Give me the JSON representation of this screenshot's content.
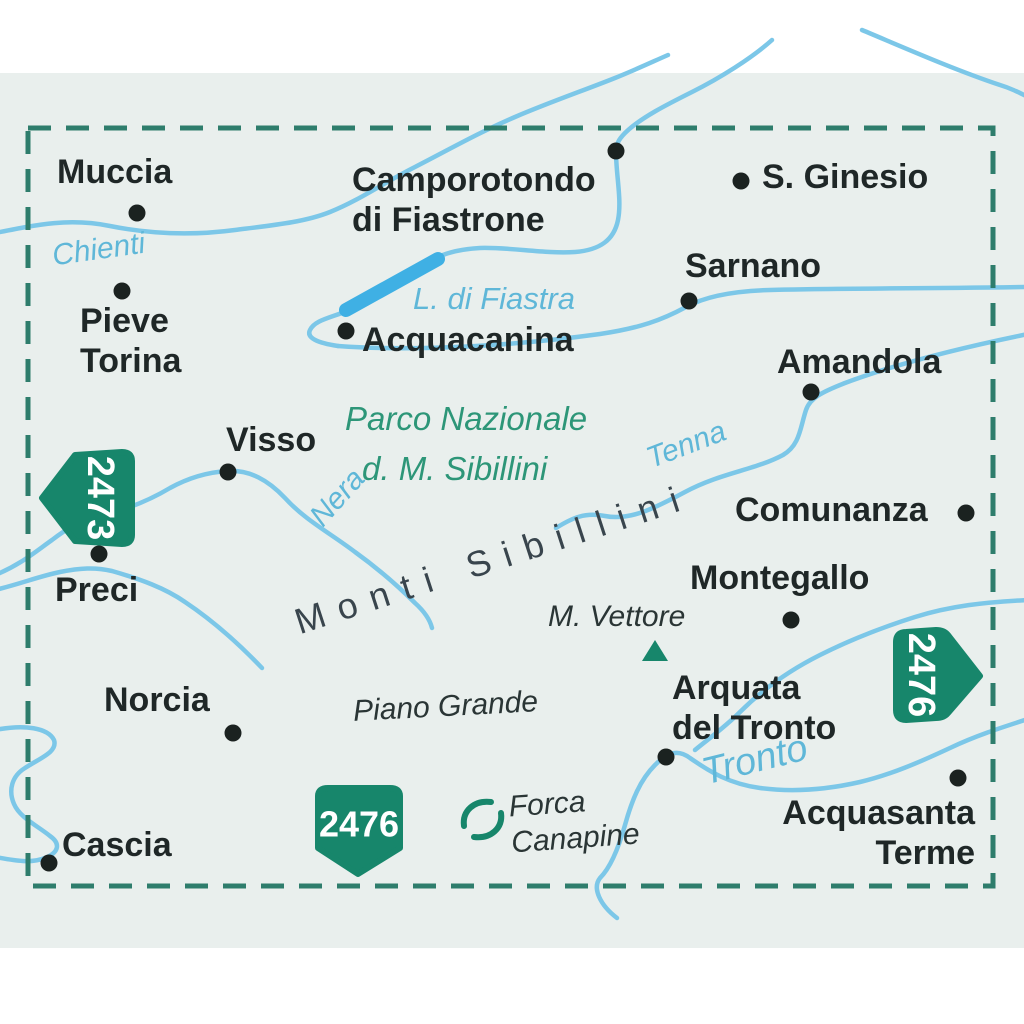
{
  "map": {
    "towns": {
      "muccia": "Muccia",
      "pieve_torina_line1": "Pieve",
      "pieve_torina_line2": "Torina",
      "camporotondo_line1": "Camporotondo",
      "camporotondo_line2": "di Fiastrone",
      "s_ginesio": "S. Ginesio",
      "sarnano": "Sarnano",
      "acquacanina": "Acquacanina",
      "amandola": "Amandola",
      "visso": "Visso",
      "comunanza": "Comunanza",
      "preci": "Preci",
      "montegallo": "Montegallo",
      "norcia": "Norcia",
      "arquata_line1": "Arquata",
      "arquata_line2": "del Tronto",
      "cascia": "Cascia",
      "acquasanta_line1": "Acquasanta",
      "acquasanta_line2": "Terme"
    },
    "rivers": {
      "chienti": "Chienti",
      "nera": "Nera",
      "tenna": "Tenna",
      "tronto": "Tronto"
    },
    "lake_label": "L. di Fiastra",
    "region_labels": {
      "park_line1": "Parco Nazionale",
      "park_line2": "d. M. Sibillini",
      "mountain_range": "Monti Sibillini",
      "peak": "M. Vettore",
      "plateau": "Piano Grande",
      "pass_line1": "Forca",
      "pass_line2": "Canapine"
    },
    "adjacent_sheet_badges": {
      "left": "2473",
      "right": "2476",
      "bottom": "2476"
    }
  },
  "colors": {
    "bg": "#E9EFED",
    "frame": "#2E7D6C",
    "river": "#7CC7E8",
    "lake": "#3FB0E4",
    "badge": "#17866B",
    "park": "#2D9678",
    "town": "#1F2727",
    "range": "#39454D",
    "riverlabel": "#5FB7D8"
  }
}
